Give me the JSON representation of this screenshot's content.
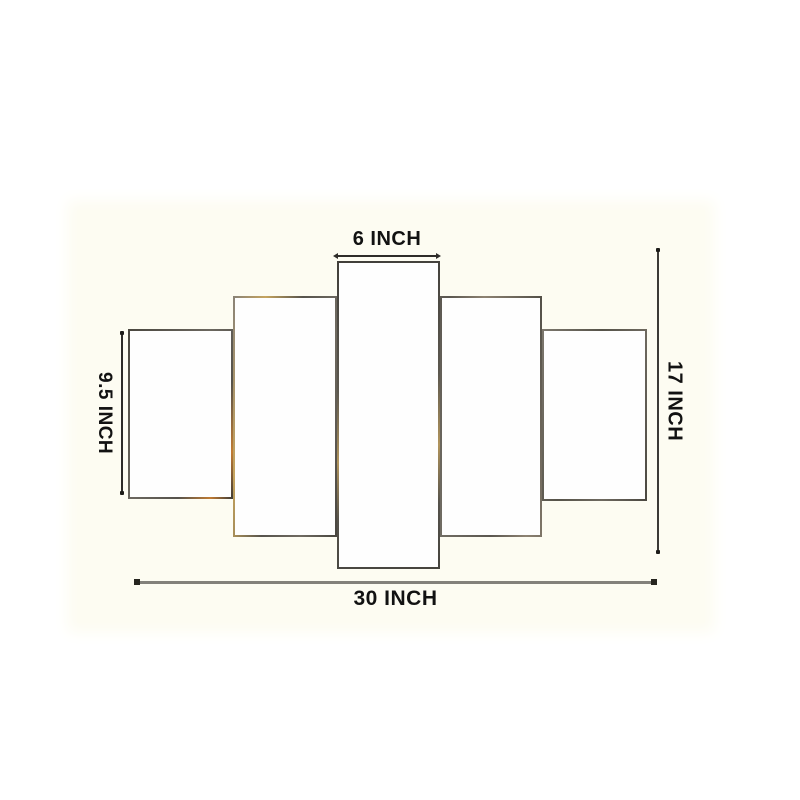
{
  "product_diagram": {
    "description": "5-panel wall art canvas set dimension diagram",
    "panel_count": 5,
    "dimension_labels": {
      "center_panel_width": "6 INCH",
      "side_panel_height": "9.5 INCH",
      "total_height": "17 INCH",
      "total_width": "30 INCH"
    },
    "panels": [
      {
        "id": "panel-1",
        "position": "far-left"
      },
      {
        "id": "panel-2",
        "position": "left"
      },
      {
        "id": "panel-3",
        "position": "center"
      },
      {
        "id": "panel-4",
        "position": "right"
      },
      {
        "id": "panel-5",
        "position": "far-right"
      }
    ],
    "colors": {
      "page_background": "#ffffff",
      "photo_background": "#fdfcf2",
      "panel_fill": "#fefefe",
      "panel_edge": "#5d5a53",
      "panel_edge_glint": "#c69a4e",
      "dimension_line": "#2e2c29",
      "bottom_line_gray": "#83817b",
      "label_text": "#121212"
    }
  }
}
